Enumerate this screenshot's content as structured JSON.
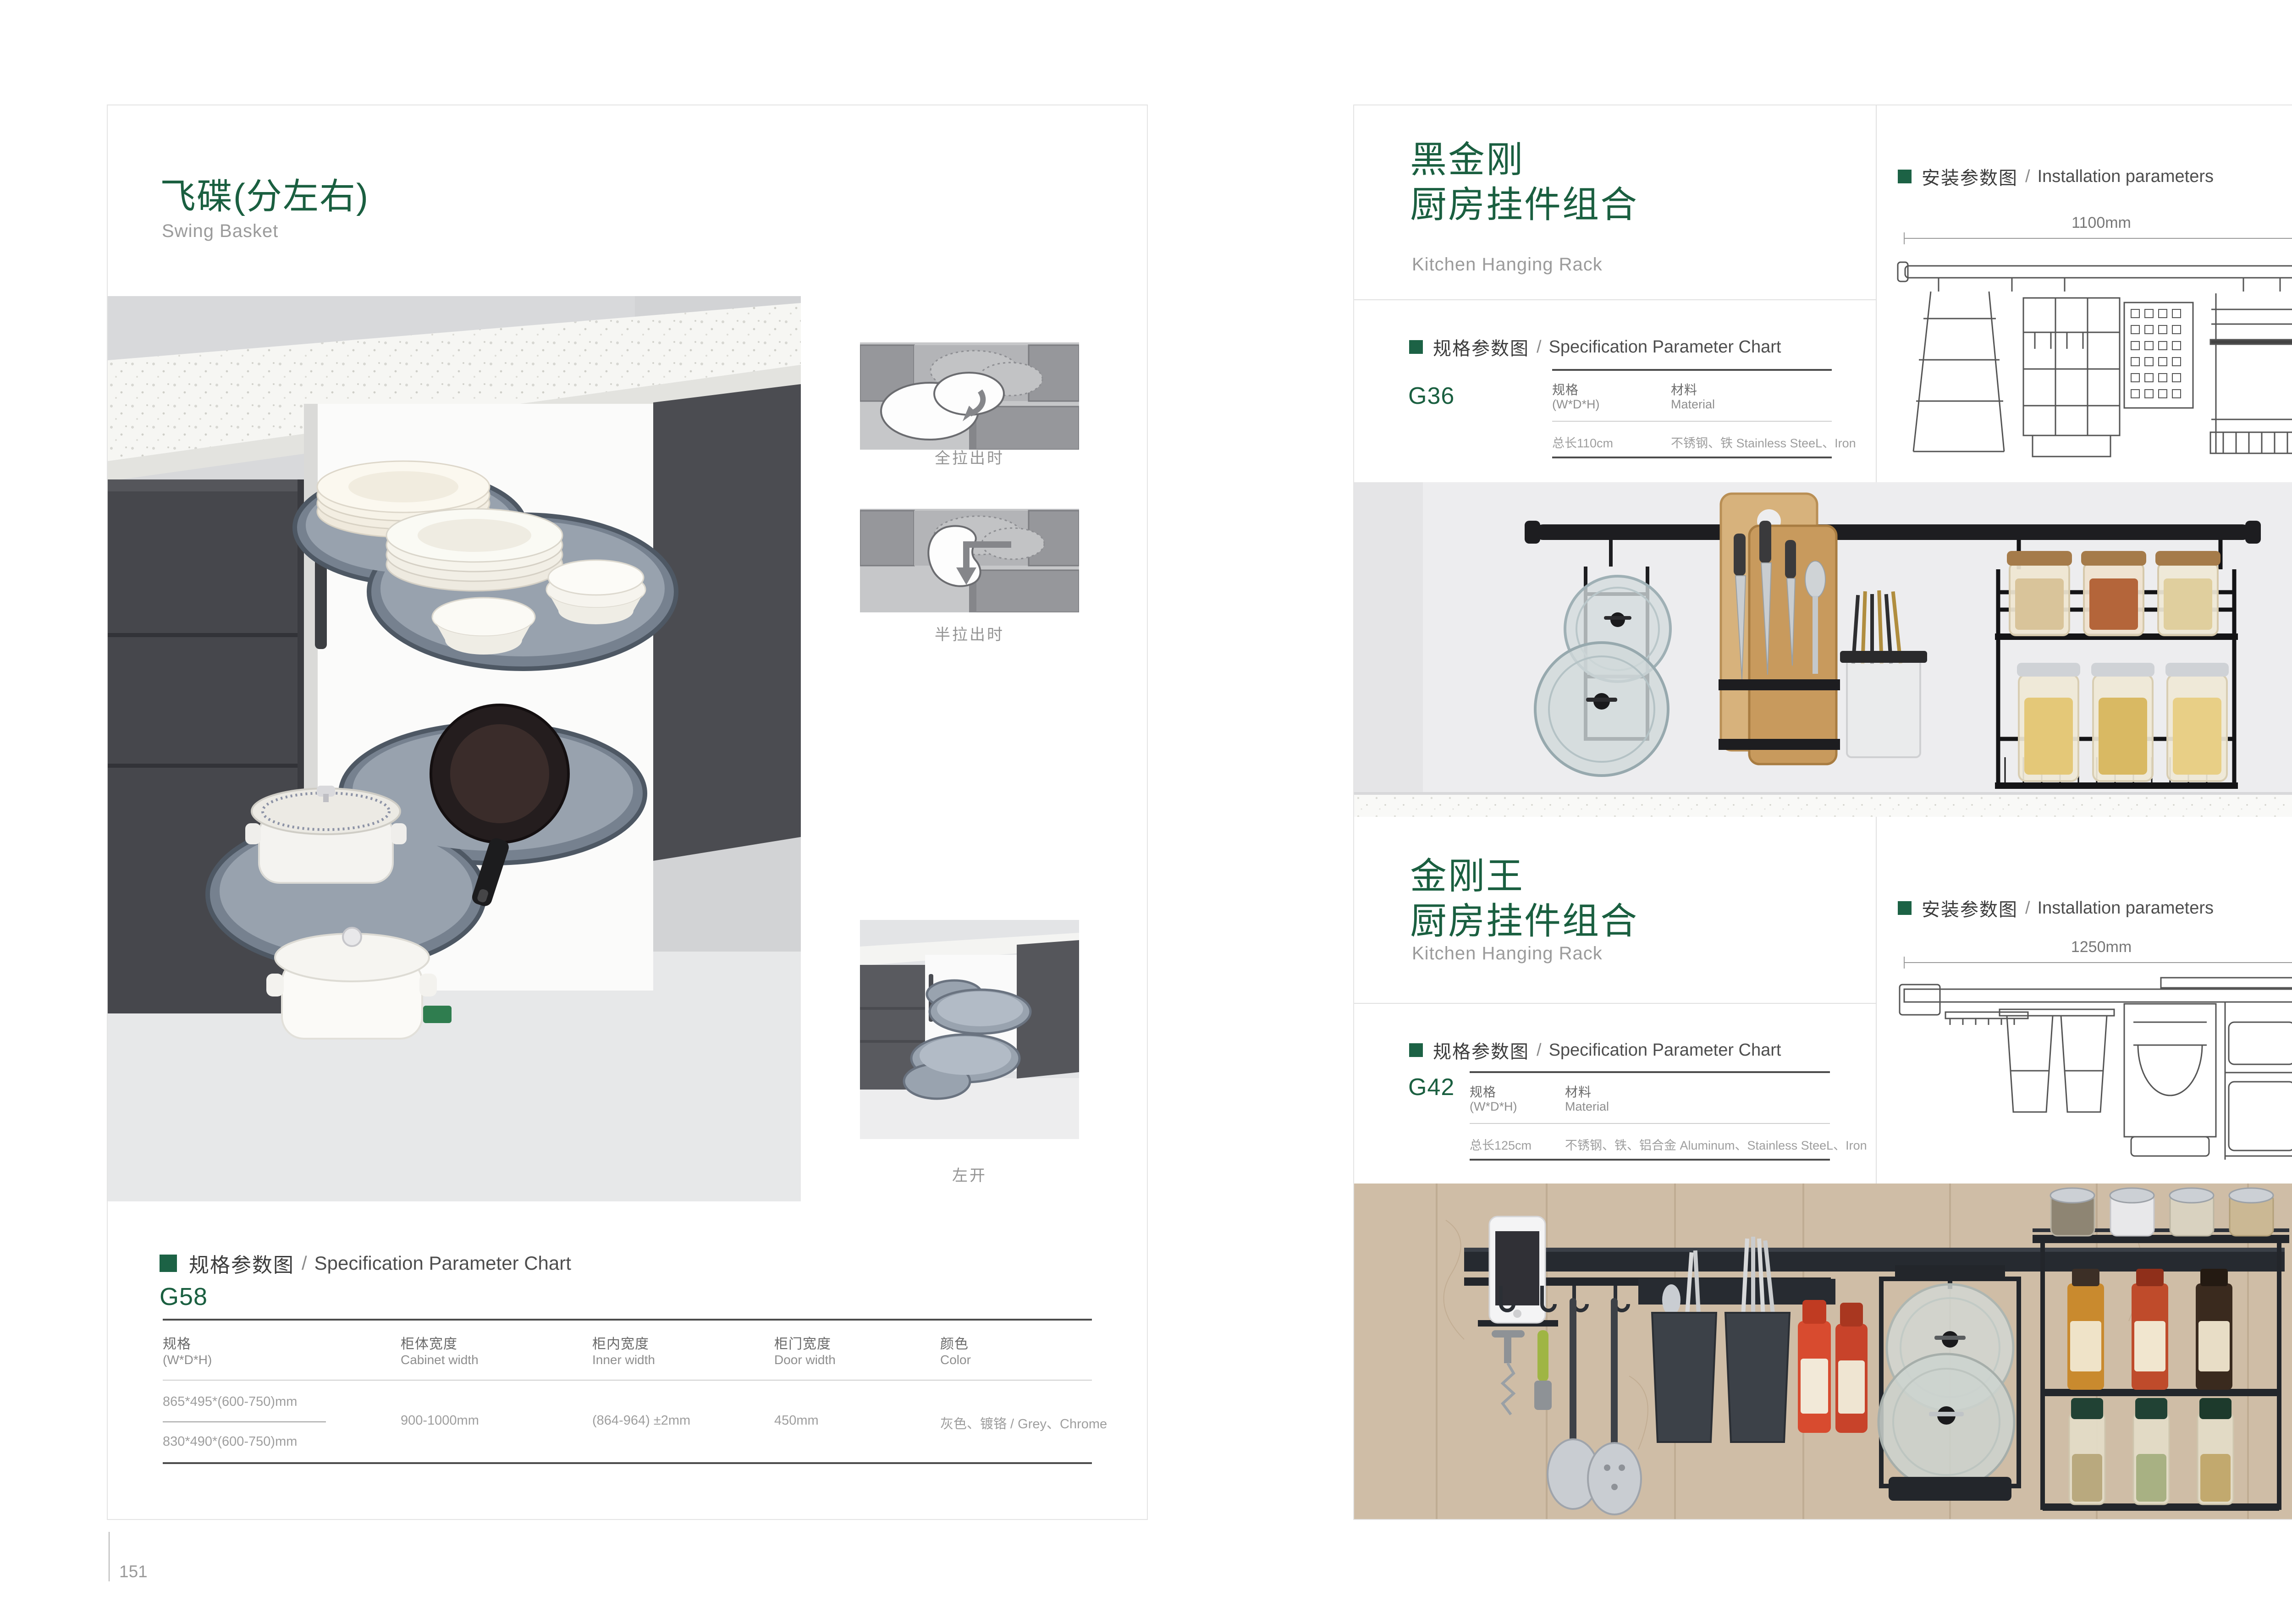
{
  "colors": {
    "accent_green": "#1c6245",
    "title_green": "#1a5f40",
    "text_dark": "#3c3c3c",
    "text_gray": "#9e9e9e",
    "line_dark": "#4b4b4b",
    "line_light": "#cfcfcf",
    "page_border": "#e4e4e4"
  },
  "left_page": {
    "page_number": "151",
    "title_cn": "飞碟(分左右)",
    "title_en": "Swing Basket",
    "diagram_labels": {
      "full_out": "全拉出时",
      "half_out": "半拉出时",
      "left_open": "左开"
    },
    "spec": {
      "section_cn": "规格参数图",
      "section_divider": "/",
      "section_en": "Specification Parameter Chart",
      "model": "G58",
      "col_size_cn": "规格",
      "col_size_en": "(W*D*H)",
      "col_cabinet_cn": "柜体宽度",
      "col_cabinet_en": "Cabinet width",
      "col_inner_cn": "柜内宽度",
      "col_inner_en": "Inner width",
      "col_door_cn": "柜门宽度",
      "col_door_en": "Door width",
      "col_color_cn": "颜色",
      "col_color_en": "Color",
      "size_1": "865*495*(600-750)mm",
      "size_2": "830*490*(600-750)mm",
      "cabinet_width": "900-1000mm",
      "inner_width": "(864-964) ±2mm",
      "door_width": "450mm",
      "color": "灰色、镀铬 / Grey、Chrome"
    }
  },
  "right_page": {
    "page_number": "152",
    "product_1": {
      "title_cn_1": "黑金刚",
      "title_cn_2": "厨房挂件组合",
      "title_en": "Kitchen Hanging Rack",
      "install": {
        "section_cn": "安装参数图",
        "divider": "/",
        "section_en": "Installation parameters",
        "width_label": "1100mm",
        "height_label": "420mm"
      },
      "spec": {
        "section_cn": "规格参数图",
        "divider": "/",
        "section_en": "Specification Parameter Chart",
        "model": "G36",
        "col_size_cn": "规格",
        "col_size_en": "(W*D*H)",
        "col_material_cn": "材料",
        "col_material_en": "Material",
        "size": "总长110cm",
        "material": "不锈钢、铁  Stainless SteeL、Iron"
      }
    },
    "product_2": {
      "title_cn_1": "金刚王",
      "title_cn_2": "厨房挂件组合",
      "title_en": "Kitchen Hanging Rack",
      "install": {
        "section_cn": "安装参数图",
        "divider": "/",
        "section_en": "Installation parameters",
        "width_label": "1250mm",
        "height_label": "430mm"
      },
      "spec": {
        "section_cn": "规格参数图",
        "divider": "/",
        "section_en": "Specification Parameter Chart",
        "model": "G42",
        "col_size_cn": "规格",
        "col_size_en": "(W*D*H)",
        "col_material_cn": "材料",
        "col_material_en": "Material",
        "size": "总长125cm",
        "material": "不锈钢、铁、铝合金  Aluminum、Stainless SteeL、Iron"
      }
    }
  }
}
